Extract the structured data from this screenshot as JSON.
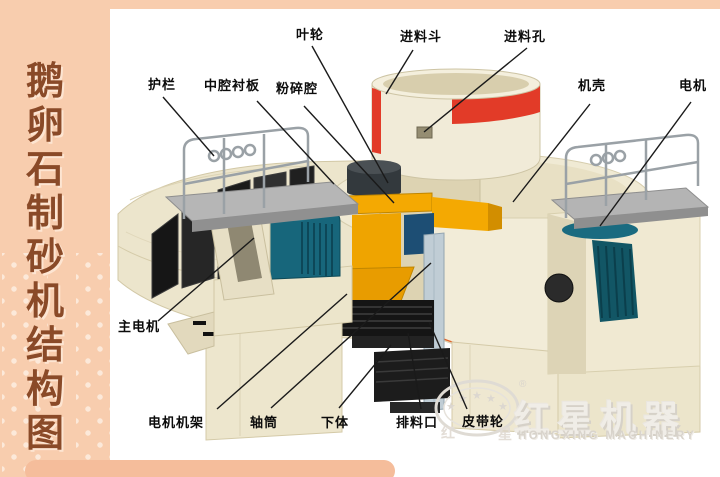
{
  "sidebar": {
    "title": "鹅卵石制砂机结构图",
    "chars": [
      "鹅",
      "卵",
      "石",
      "制",
      "砂",
      "机",
      "结",
      "构",
      "图"
    ],
    "bg_color": "#f8cdae",
    "text_color": "#8a4a28",
    "bottom_bar_color": "#f5bd9b"
  },
  "diagram": {
    "title": "鹅卵石制砂机结构图",
    "labels": [
      {
        "name": "impeller",
        "text": "叶轮"
      },
      {
        "name": "feed-hopper",
        "text": "进料斗"
      },
      {
        "name": "feed-hole",
        "text": "进料孔"
      },
      {
        "name": "guardrail",
        "text": "护栏"
      },
      {
        "name": "middle-cavity-liner",
        "text": "中腔衬板"
      },
      {
        "name": "crushing-chamber",
        "text": "粉碎腔"
      },
      {
        "name": "casing",
        "text": "机壳"
      },
      {
        "name": "motor",
        "text": "电机"
      },
      {
        "name": "main-motor",
        "text": "主电机"
      },
      {
        "name": "motor-frame",
        "text": "电机机架"
      },
      {
        "name": "shaft-sleeve",
        "text": "轴筒"
      },
      {
        "name": "lower-body",
        "text": "下体"
      },
      {
        "name": "discharge-port",
        "text": "排料口"
      },
      {
        "name": "belt-pulley",
        "text": "皮带轮"
      }
    ]
  },
  "watermark": {
    "brand_cn": "红星机器",
    "brand_en": "HONGXING MACHINERY",
    "reg_mark": "®",
    "emblem_char_left": "红",
    "emblem_char_right": "星",
    "star_glyph": "★"
  },
  "colors": {
    "machine_cream": "#f0ead5",
    "accent_red": "#e23b28",
    "trim_orange": "#e0662e",
    "impeller_yellow": "#f4a902",
    "motor_teal": "#17667b",
    "platform_gray": "#b5b5b5",
    "shaft_gray": "#c0cdd5",
    "liner_black": "#1b1b1b"
  }
}
